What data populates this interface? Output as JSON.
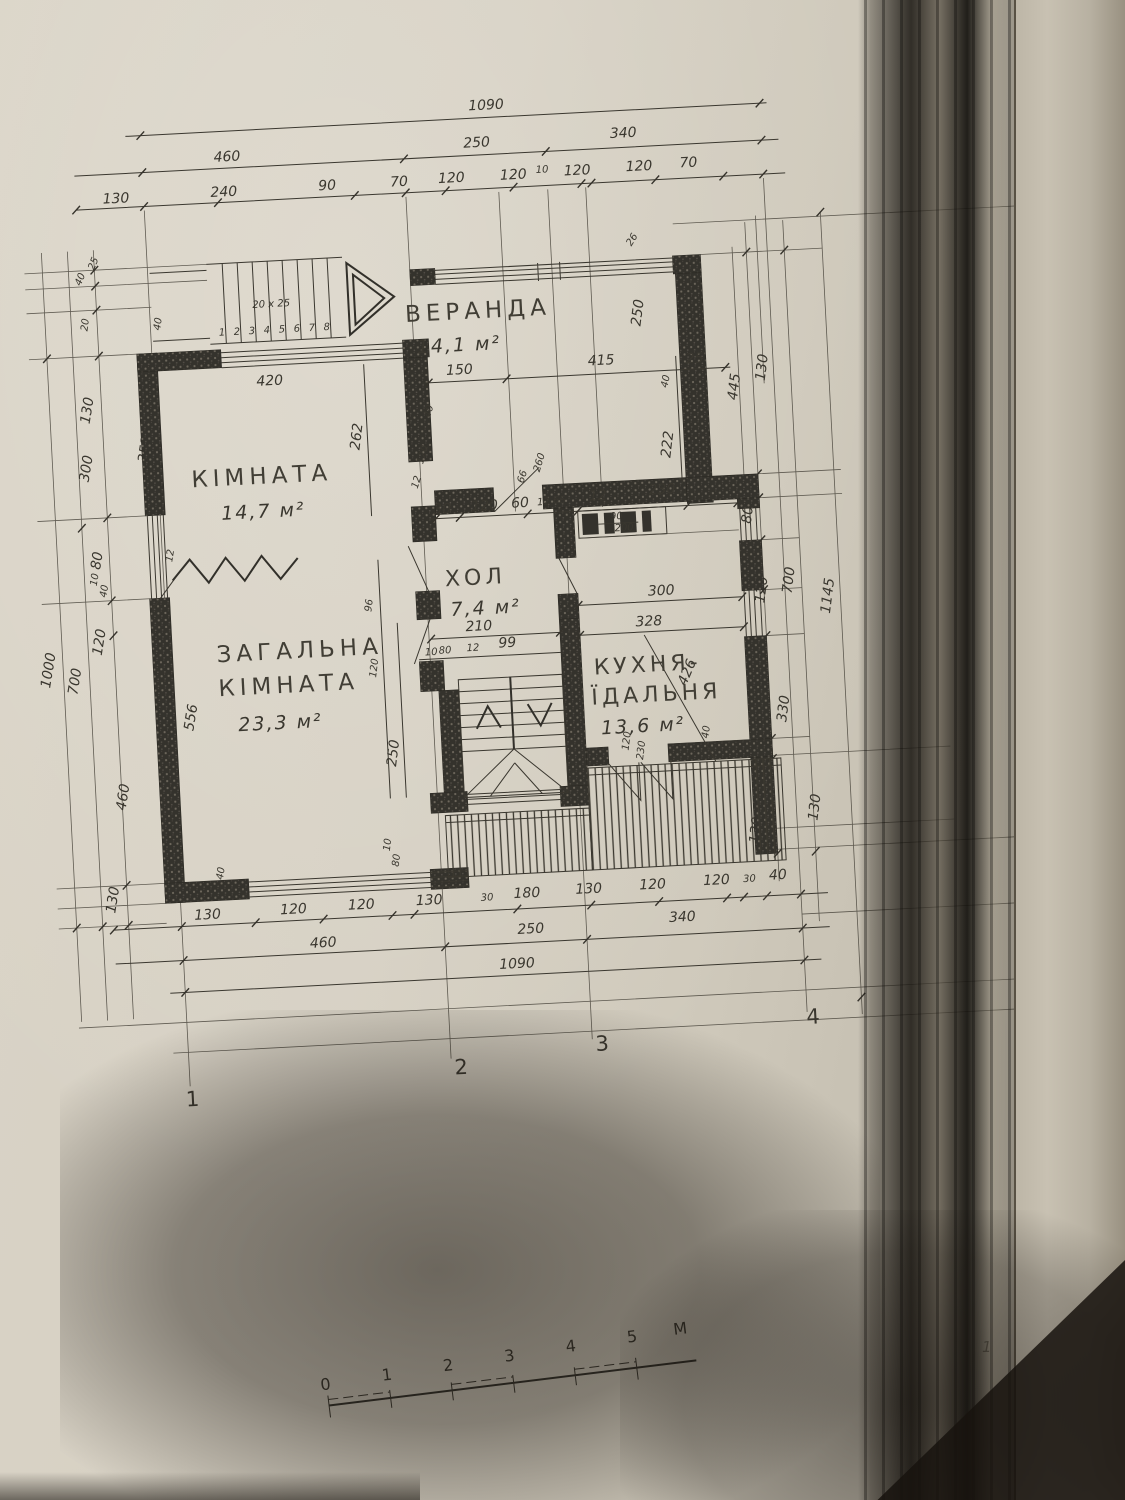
{
  "page_marker": "1",
  "rooms": {
    "veranda": {
      "name": "ВЕРАНДА",
      "area": "14,1 м²"
    },
    "room": {
      "name": "КІМНАТА",
      "area": "14,7 м²"
    },
    "living": {
      "lines": [
        "ЗАГАЛЬНА",
        "КІМНАТА"
      ],
      "area": "23,3 м²"
    },
    "hall": {
      "name": "ХОЛ",
      "area": "7,4 м²"
    },
    "kitchen": {
      "lines": [
        "КУХНЯ-",
        "ЇДАЛЬНЯ"
      ],
      "area": "13,6 м²"
    }
  },
  "stair": {
    "note": "20 х 25",
    "steps": [
      "1",
      "2",
      "3",
      "4",
      "5",
      "6",
      "7",
      "8"
    ]
  },
  "dims": {
    "top_total": "1090",
    "top_row2": [
      "460",
      "250",
      "340"
    ],
    "top_row3": [
      "130",
      "240",
      "90",
      "70",
      "120",
      "120",
      "10",
      "120",
      "120",
      "70"
    ],
    "bottom_row3": [
      "130",
      "120",
      "120",
      "130",
      "30",
      "180",
      "130",
      "120",
      "120",
      "30",
      "40"
    ],
    "bottom_row2": [
      "460",
      "250",
      "340"
    ],
    "bottom_total": "1090",
    "left": [
      "40",
      "25",
      "20",
      "130",
      "300",
      "80",
      "10",
      "40",
      "120",
      "1000",
      "700",
      "460",
      "130"
    ],
    "left_inner": [
      "40",
      "352",
      "12",
      "556",
      "40"
    ],
    "right": [
      "26",
      "250",
      "445",
      "130",
      "80",
      "40",
      "120",
      "700",
      "1145",
      "330",
      "130",
      "130"
    ],
    "interior": [
      "420",
      "150",
      "415",
      "40",
      "25",
      "262",
      "40",
      "120",
      "12",
      "30",
      "120",
      "60",
      "12",
      "66",
      "12",
      "230",
      "66",
      "260",
      "222",
      "90",
      "200",
      "210",
      "10",
      "80",
      "12",
      "99",
      "300",
      "328",
      "426",
      "40",
      "120",
      "230",
      "250",
      "96",
      "120",
      "10",
      "80"
    ]
  },
  "axes": [
    "1",
    "2",
    "3",
    "4"
  ],
  "scale_bar": {
    "ticks": [
      "0",
      "1",
      "2",
      "3",
      "4",
      "5"
    ],
    "unit": "М"
  }
}
